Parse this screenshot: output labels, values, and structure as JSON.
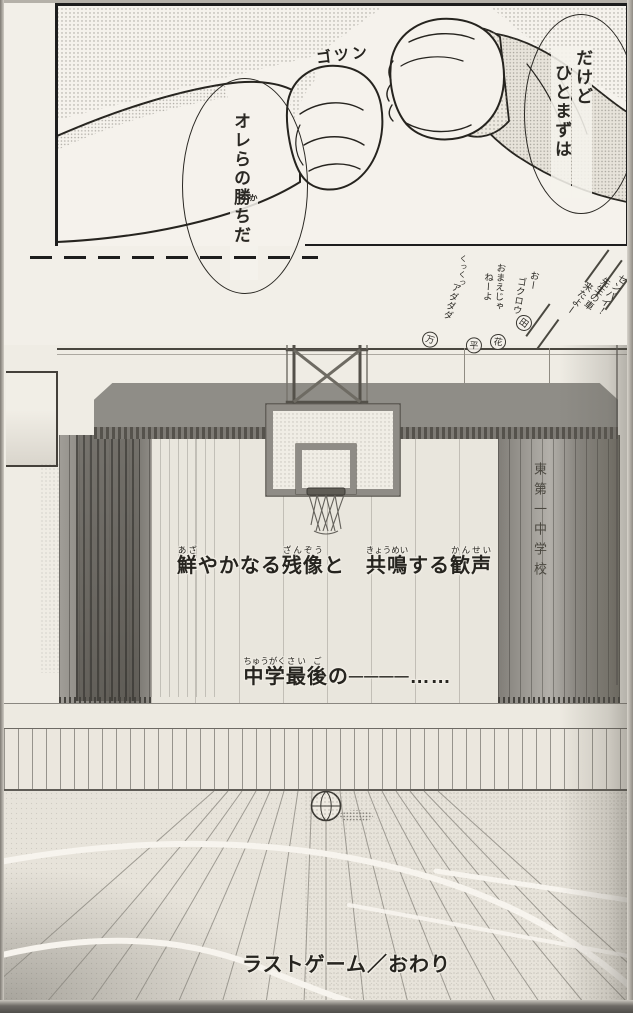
{
  "palette": {
    "ink": "#1d1d1d",
    "paper": "#f2efe8",
    "curtain_gray": "#6f6c66"
  },
  "manga": {
    "sfx_impact": "ゴツン",
    "bubble_right_lines": [
      "だけど",
      "ひとまずは"
    ],
    "bubble_left_segments": [
      {
        "b": "オレらの"
      },
      {
        "b": "勝",
        "r": "か"
      },
      {
        "b": "ちだ"
      }
    ],
    "chatter": {
      "item1": {
        "lines": [
          "センパイ！",
          "先生の車",
          "来たよー"
        ],
        "mark": "田"
      },
      "item2": {
        "lines": [
          "おー",
          "ゴクロウ"
        ],
        "mark": "花"
      },
      "item3": {
        "laugh": "くっくっ",
        "lines": [
          "おまえじゃ",
          "ねーよ"
        ],
        "mark": "平"
      },
      "item4": {
        "lines": [
          "アダダダ"
        ],
        "mark": "万"
      }
    },
    "curtain_school_name": "東第一中学校",
    "caption_afterimage_segments": [
      {
        "b": "鮮",
        "r": "あざ"
      },
      {
        "b": "やかなる"
      },
      {
        "b": "残像",
        "r": "ざんぞう"
      },
      {
        "b": "と"
      },
      {
        "b": "　"
      },
      {
        "b": "共鳴",
        "r": "きょうめい"
      },
      {
        "b": "する"
      },
      {
        "b": "歓声",
        "r": "かんせい"
      }
    ],
    "caption_last_segments": [
      {
        "b": "中学",
        "r": "ちゅうがく"
      },
      {
        "b": "最",
        "r": "さい"
      },
      {
        "b": "後",
        "r": "ご"
      },
      {
        "b": "の"
      },
      {
        "b": "────"
      },
      {
        "b": "……"
      }
    ],
    "ending_caption": "ラストゲーム／おわり"
  }
}
